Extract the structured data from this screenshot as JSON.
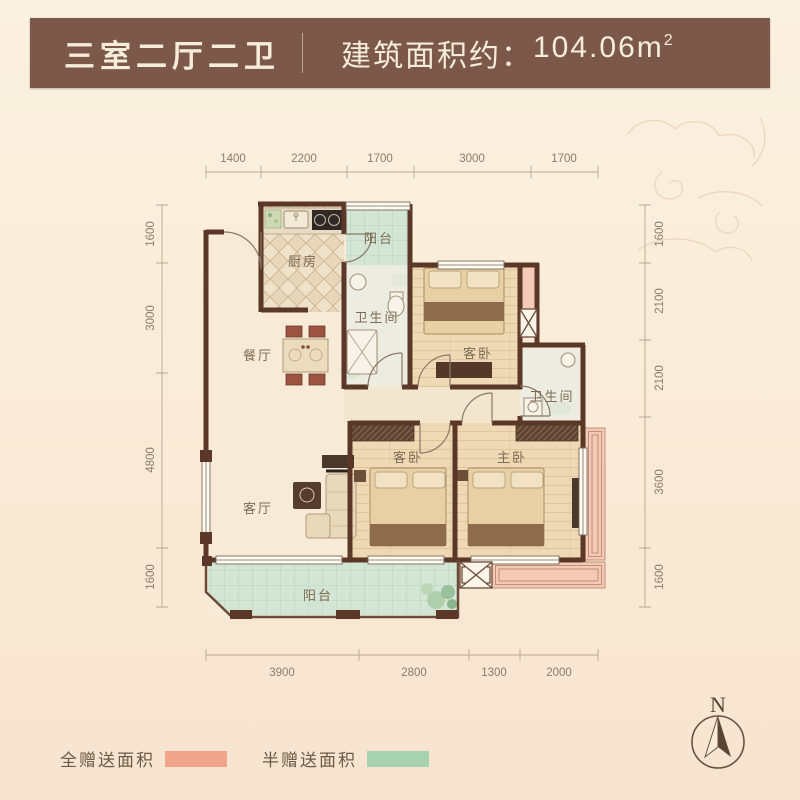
{
  "header": {
    "title": "三室二厅二卫",
    "area_prefix": "建筑面积约：",
    "area_value": "104.06m",
    "area_sup": "2"
  },
  "rooms": {
    "kitchen": "厨房",
    "balcony_top": "阳台",
    "bath_top": "卫生间",
    "bed_guest_top": "客卧",
    "bath_right": "卫生间",
    "dining": "餐厅",
    "living": "客厅",
    "bed_guest_bottom": "客卧",
    "bed_master": "主卧",
    "balcony_bottom": "阳台"
  },
  "dimensions": {
    "top": [
      "1400",
      "2200",
      "1700",
      "3000",
      "1700"
    ],
    "left": [
      "1600",
      "3000",
      "4800",
      "1600"
    ],
    "right": [
      "1600",
      "2100",
      "2100",
      "3600",
      "1600"
    ],
    "bottom": [
      "3900",
      "2800",
      "1300",
      "2000"
    ]
  },
  "legend": {
    "full": {
      "label": "全赠送面积",
      "color": "#f0a48c"
    },
    "half": {
      "label": "半赠送面积",
      "color": "#a7d2af"
    }
  },
  "compass": {
    "label": "N"
  },
  "colors": {
    "header_bg": "#7b584a",
    "wall": "#5a3726",
    "balcony_fill": "#d3e5d5",
    "gift_fill": "#f4c9b6"
  }
}
